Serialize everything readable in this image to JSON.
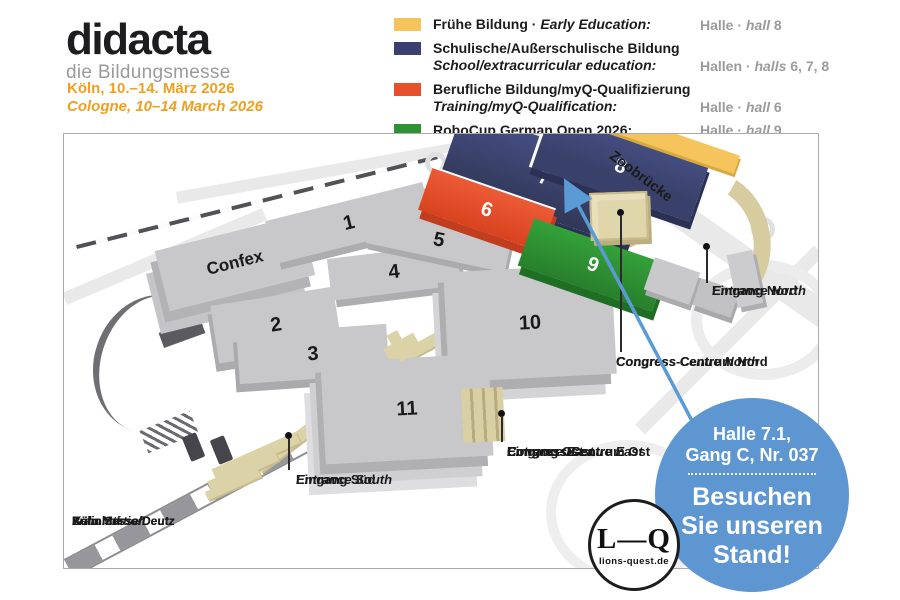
{
  "brand": {
    "logo": "didacta",
    "tagline": "die Bildungsmesse",
    "date_de": "Köln, 10.–14. März 2026",
    "date_en": "Cologne, 10–14 March 2026"
  },
  "legend": {
    "items": [
      {
        "color": "#F6C45C",
        "label_de": "Frühe Bildung ·",
        "label_en": "Early Education:",
        "hall_de": "Halle ·",
        "hall_en": "hall",
        "hall_num": "8"
      },
      {
        "color": "#3A4170",
        "label_de": "Schulische/Außerschulische Bildung",
        "label_en": "School/extracurricular education:",
        "hall_de": "Hallen ·",
        "hall_en": "halls",
        "hall_num": "6, 7, 8"
      },
      {
        "color": "#E8502D",
        "label_de": "Berufliche Bildung/myQ-Qualifizierung",
        "label_en": "Training/myQ-Qualification:",
        "hall_de": "Halle ·",
        "hall_en": "hall",
        "hall_num": "6"
      },
      {
        "color": "#2E9235",
        "label_de": "RoboCup German Open 2026:",
        "label_en": "",
        "hall_de": "Halle ·",
        "hall_en": "hall",
        "hall_num": "9"
      }
    ]
  },
  "map": {
    "halls": [
      {
        "label": "Confex"
      },
      {
        "label": "1"
      },
      {
        "label": "2"
      },
      {
        "label": "3"
      },
      {
        "label": "4"
      },
      {
        "label": "5"
      },
      {
        "label": "6",
        "color": "#E8502D"
      },
      {
        "label": "7",
        "color": "#3A4170"
      },
      {
        "label": "8",
        "color": "#3A4170"
      },
      {
        "label": "9",
        "color": "#2E9235"
      },
      {
        "label": "10"
      },
      {
        "label": "11"
      }
    ],
    "labels": {
      "zoobruecke": "Zoobrücke",
      "eingang_nord_de": "Eingang Nord",
      "eingang_nord_en": "Entrance North",
      "congress_nord_de": "Congress-Centrum Nord",
      "congress_nord_en": "Congress Centre North",
      "eingang_ost_de": "Eingang Ost",
      "eingang_ost_en": "Entrance East",
      "congress_ost_de": "Congress-Centrum Ost",
      "congress_ost_en": "Congress Centre East",
      "eingang_sued_de": "Eingang Süd",
      "eingang_sued_en": "Entrance South",
      "bahnhof_l1": "Bahnhof",
      "bahnhof_l2": "Köln Messe/Deutz",
      "bahnhof_l3": "Train Station",
      "bahnhof_l4": "Köln Messe/Deutz"
    },
    "badge": {
      "color": "#5E96D2",
      "location_line1": "Halle 7.1,",
      "location_line2": "Gang C, Nr. 037",
      "cta_line1": "Besuchen",
      "cta_line2": "Sie unseren",
      "cta_line3": "Stand!"
    },
    "lq_logo": {
      "monogram": "L—Q",
      "url": "lions-quest.de"
    }
  }
}
